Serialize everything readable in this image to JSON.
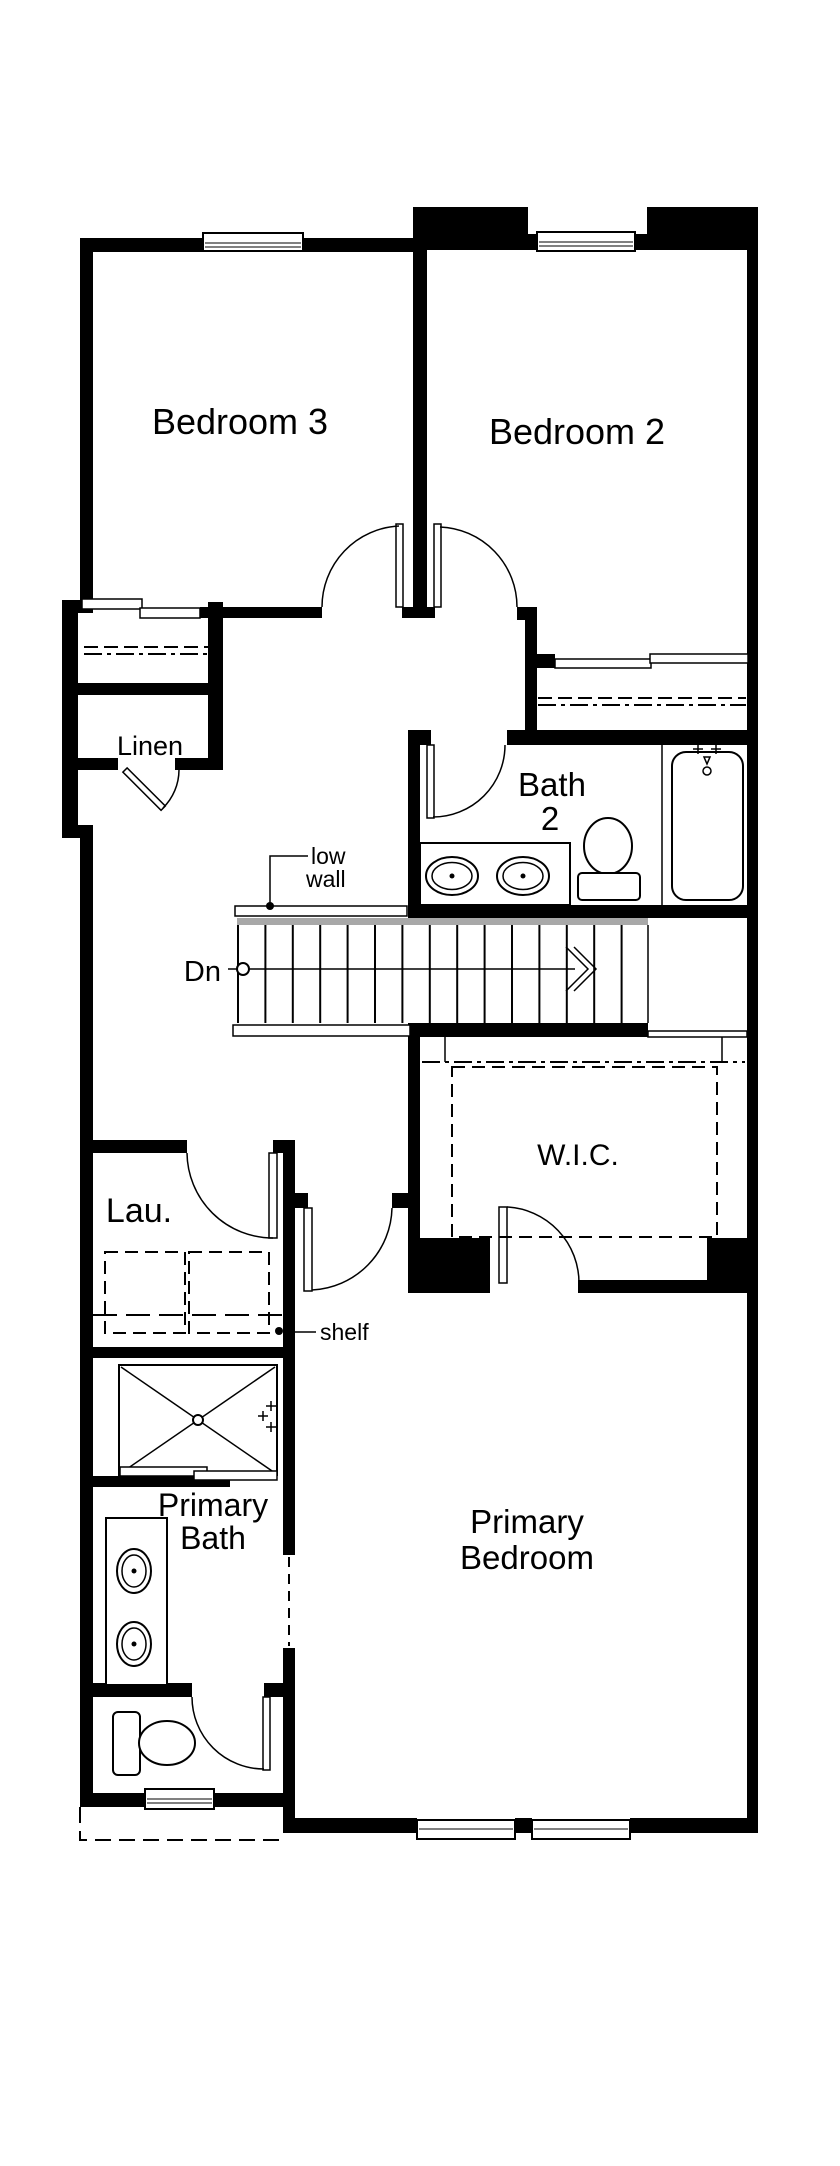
{
  "document": {
    "type": "second-floor-plan"
  },
  "colors": {
    "walls": "#000000",
    "background": "#ffffff",
    "stair_accent": "#a8a8a8"
  },
  "rooms": {
    "bedroom3": {
      "label": "Bedroom 3"
    },
    "bedroom2": {
      "label": "Bedroom 2"
    },
    "linen": {
      "label": "Linen"
    },
    "bath2": {
      "line1": "Bath",
      "line2": "2"
    },
    "wic": {
      "label": "W.I.C."
    },
    "laundry": {
      "label": "Lau."
    },
    "primary_bath": {
      "line1": "Primary",
      "line2": "Bath"
    },
    "primary_bedroom": {
      "line1": "Primary",
      "line2": "Bedroom"
    }
  },
  "annotations": {
    "down": "Dn",
    "low_wall": {
      "line1": "low",
      "line2": "wall"
    },
    "shelf": "shelf"
  }
}
